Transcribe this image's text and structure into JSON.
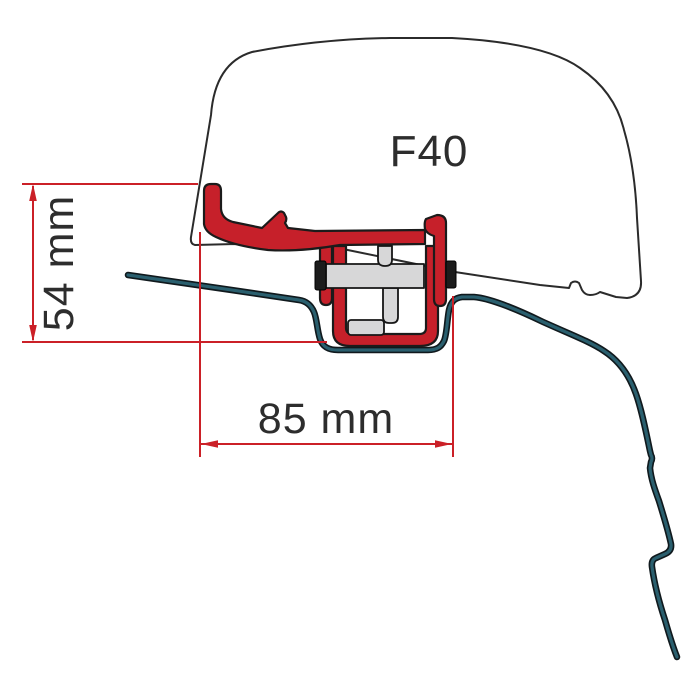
{
  "diagram": {
    "product_label": "F40",
    "dimension_height_label": "54 mm",
    "dimension_width_label": "85 mm",
    "colors": {
      "bracket_red": "#c6202a",
      "dimension_red": "#cb2027",
      "roof_teal": "#2a5f6e",
      "case_outline": "#2b2b2b",
      "hardware_gray": "#d7d7d8",
      "pad_black": "#1c1c1c",
      "label_text": "#2d2d2d",
      "background": "#ffffff"
    }
  }
}
